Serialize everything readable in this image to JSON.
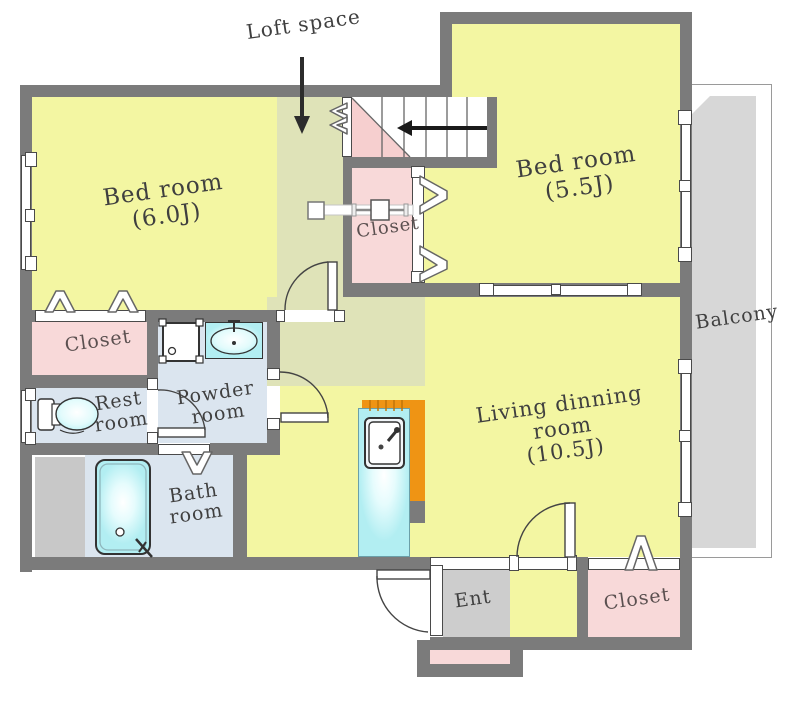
{
  "floorplan": {
    "loft_label": "Loft space",
    "bedroom_left": {
      "name": "Bed room",
      "size": "(6.0J)"
    },
    "bedroom_right": {
      "name": "Bed room",
      "size": "(5.5J)"
    },
    "living_room": {
      "line1": "Living dinning",
      "line2": "room",
      "size": "(10.5J)"
    },
    "closet_middle": "Closet",
    "closet_left": "Closet",
    "closet_bottom_right": "Closet",
    "balcony": "Balcony",
    "rest_room": {
      "line1": "Rest",
      "line2": "room"
    },
    "powder_room": {
      "line1": "Powder",
      "line2": "room"
    },
    "bath_room": {
      "line1": "Bath",
      "line2": "room"
    },
    "entrance": "Ent"
  },
  "colors": {
    "wall": "#7b7b7b",
    "room_yellow": "#f3f6a2",
    "loft_tint": "#dfe3b8",
    "closet_pink": "#f8d9d9",
    "wet_area_blue": "#dbe5ef",
    "fixture_cyan": "#b2eff2",
    "kitchen_orange": "#ef9414",
    "balcony_gray": "#d7d7d7",
    "entrance_gray": "#cdcdcd",
    "stairs_triangle_pink": "#f6cfcf",
    "text": "#3f3f3f"
  }
}
